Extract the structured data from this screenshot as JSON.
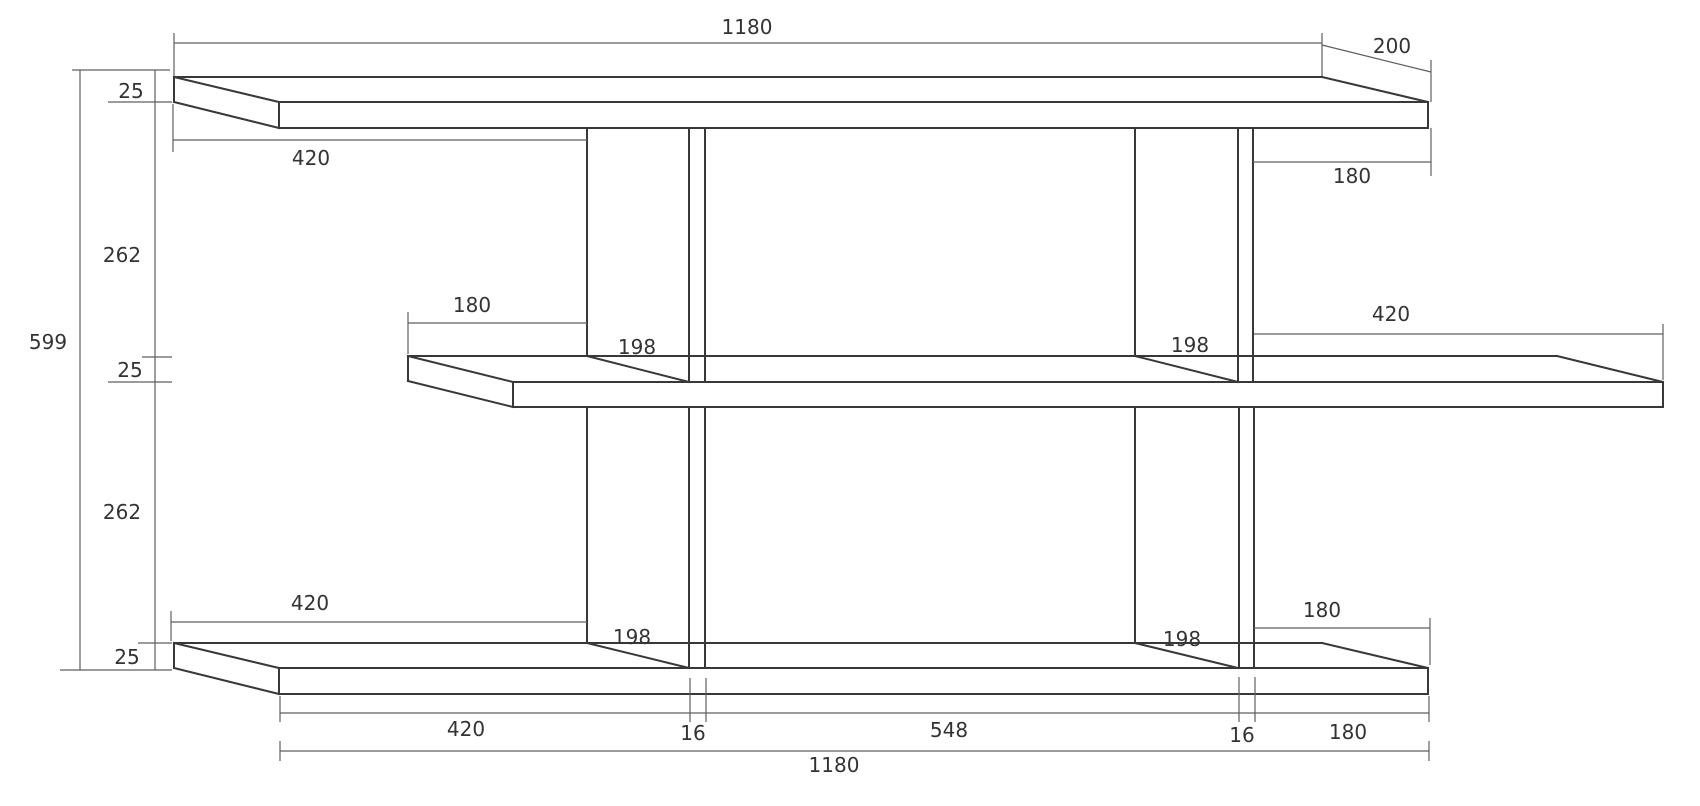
{
  "page": {
    "background": "#ffffff"
  },
  "summary": {
    "visible_dimension_values": [
      "1180",
      "200",
      "25",
      "420",
      "180",
      "262",
      "599",
      "198",
      "16",
      "548"
    ],
    "overall_width": "1180",
    "overall_height": "599",
    "shelf_depth": "200",
    "board_thickness": "25",
    "shelf_clear_gap": "262",
    "divider_thickness": "16",
    "divider_depth": "198",
    "bottom_segments": [
      "420",
      "16",
      "548",
      "16",
      "180"
    ]
  },
  "drawing": {
    "width": 1700,
    "height": 806,
    "background": "#ffffff",
    "object_color": "#383838",
    "dim_color": "#5f5f5f",
    "text_color": "#333333",
    "object_stroke_width": 2,
    "dim_stroke_width": 1.2,
    "font_size": 20,
    "parts": [
      {
        "name": "top-shelf",
        "role": "object",
        "strokes": [
          [
            [
              174,
              77
            ],
            [
              1322,
              77
            ]
          ],
          [
            [
              174,
              77
            ],
            [
              174,
              102
            ]
          ],
          [
            [
              174,
              77
            ],
            [
              279,
              102
            ]
          ],
          [
            [
              174,
              102
            ],
            [
              279,
              128
            ]
          ],
          [
            [
              279,
              102
            ],
            [
              279,
              128
            ]
          ],
          [
            [
              279,
              102
            ],
            [
              1428,
              102
            ]
          ],
          [
            [
              279,
              128
            ],
            [
              1428,
              128
            ]
          ],
          [
            [
              1322,
              77
            ],
            [
              1428,
              102
            ]
          ],
          [
            [
              1428,
              102
            ],
            [
              1428,
              128
            ]
          ]
        ]
      },
      {
        "name": "middle-shelf",
        "role": "object",
        "strokes": [
          [
            [
              408,
              356
            ],
            [
              1557,
              356
            ]
          ],
          [
            [
              408,
              356
            ],
            [
              408,
              381
            ]
          ],
          [
            [
              408,
              356
            ],
            [
              513,
              382
            ]
          ],
          [
            [
              408,
              381
            ],
            [
              513,
              407
            ]
          ],
          [
            [
              513,
              382
            ],
            [
              513,
              407
            ]
          ],
          [
            [
              513,
              382
            ],
            [
              1663,
              382
            ]
          ],
          [
            [
              513,
              407
            ],
            [
              1663,
              407
            ]
          ],
          [
            [
              1557,
              356
            ],
            [
              1663,
              382
            ]
          ],
          [
            [
              1663,
              382
            ],
            [
              1663,
              407
            ]
          ]
        ]
      },
      {
        "name": "bottom-shelf",
        "role": "object",
        "strokes": [
          [
            [
              174,
              643
            ],
            [
              1322,
              643
            ]
          ],
          [
            [
              174,
              643
            ],
            [
              174,
              668
            ]
          ],
          [
            [
              174,
              643
            ],
            [
              279,
              668
            ]
          ],
          [
            [
              174,
              668
            ],
            [
              279,
              694
            ]
          ],
          [
            [
              279,
              668
            ],
            [
              279,
              694
            ]
          ],
          [
            [
              279,
              668
            ],
            [
              1428,
              668
            ]
          ],
          [
            [
              279,
              694
            ],
            [
              1428,
              694
            ]
          ],
          [
            [
              1322,
              643
            ],
            [
              1428,
              668
            ]
          ],
          [
            [
              1428,
              668
            ],
            [
              1428,
              694
            ]
          ]
        ]
      },
      {
        "name": "divider-upper-left",
        "role": "object",
        "strokes": [
          [
            [
              587,
              128
            ],
            [
              587,
              356
            ]
          ],
          [
            [
              587,
              356
            ],
            [
              689,
              382
            ]
          ],
          [
            [
              689,
              128
            ],
            [
              689,
              382
            ]
          ],
          [
            [
              705,
              128
            ],
            [
              705,
              382
            ]
          ]
        ]
      },
      {
        "name": "divider-upper-right",
        "role": "object",
        "strokes": [
          [
            [
              1135,
              128
            ],
            [
              1135,
              356
            ]
          ],
          [
            [
              1135,
              356
            ],
            [
              1238,
              382
            ]
          ],
          [
            [
              1238,
              128
            ],
            [
              1238,
              382
            ]
          ],
          [
            [
              1253,
              128
            ],
            [
              1253,
              382
            ]
          ]
        ]
      },
      {
        "name": "divider-lower-left",
        "role": "object",
        "strokes": [
          [
            [
              587,
              407
            ],
            [
              587,
              643
            ]
          ],
          [
            [
              587,
              643
            ],
            [
              689,
              668
            ]
          ],
          [
            [
              689,
              407
            ],
            [
              689,
              668
            ]
          ],
          [
            [
              705,
              407
            ],
            [
              705,
              668
            ]
          ]
        ]
      },
      {
        "name": "divider-lower-right",
        "role": "object",
        "strokes": [
          [
            [
              1135,
              407
            ],
            [
              1135,
              643
            ]
          ],
          [
            [
              1135,
              643
            ],
            [
              1238,
              668
            ]
          ],
          [
            [
              1239,
              407
            ],
            [
              1239,
              668
            ]
          ],
          [
            [
              1254,
              407
            ],
            [
              1254,
              668
            ]
          ]
        ]
      },
      {
        "name": "dim-top-width-1180",
        "role": "dimension",
        "strokes": [
          [
            [
              174,
              43
            ],
            [
              1322,
              43
            ]
          ],
          [
            [
              174,
              33
            ],
            [
              174,
              76
            ]
          ],
          [
            [
              1322,
              33
            ],
            [
              1322,
              76
            ]
          ]
        ]
      },
      {
        "name": "dim-depth-200",
        "role": "dimension",
        "strokes": [
          [
            [
              1322,
              45
            ],
            [
              1431,
              72
            ]
          ],
          [
            [
              1431,
              60
            ],
            [
              1431,
              102
            ]
          ]
        ]
      },
      {
        "name": "dim-top-left-420",
        "role": "dimension",
        "strokes": [
          [
            [
              173,
              140
            ],
            [
              587,
              140
            ]
          ],
          [
            [
              173,
              104
            ],
            [
              173,
              152
            ]
          ]
        ]
      },
      {
        "name": "dim-top-right-180",
        "role": "dimension",
        "strokes": [
          [
            [
              1253,
              162
            ],
            [
              1431,
              162
            ]
          ],
          [
            [
              1431,
              128
            ],
            [
              1431,
              176
            ]
          ]
        ]
      },
      {
        "name": "dim-middle-left-180",
        "role": "dimension",
        "strokes": [
          [
            [
              408,
              323
            ],
            [
              587,
              323
            ]
          ],
          [
            [
              408,
              312
            ],
            [
              408,
              354
            ]
          ]
        ]
      },
      {
        "name": "dim-middle-right-420",
        "role": "dimension",
        "strokes": [
          [
            [
              1254,
              334
            ],
            [
              1663,
              334
            ]
          ],
          [
            [
              1663,
              324
            ],
            [
              1663,
              380
            ]
          ]
        ]
      },
      {
        "name": "dim-bottom-left-420",
        "role": "dimension",
        "strokes": [
          [
            [
              171,
              622
            ],
            [
              587,
              622
            ]
          ],
          [
            [
              171,
              611
            ],
            [
              171,
              641
            ]
          ]
        ]
      },
      {
        "name": "dim-bottom-right-180",
        "role": "dimension",
        "strokes": [
          [
            [
              1254,
              628
            ],
            [
              1430,
              628
            ]
          ],
          [
            [
              1430,
              618
            ],
            [
              1430,
              665
            ]
          ]
        ]
      },
      {
        "name": "dim-bottom-segments-row",
        "role": "dimension",
        "strokes": [
          [
            [
              280,
              713
            ],
            [
              1429,
              713
            ]
          ],
          [
            [
              280,
              696
            ],
            [
              280,
              722
            ]
          ],
          [
            [
              690,
              678
            ],
            [
              690,
              722
            ]
          ],
          [
            [
              706,
              678
            ],
            [
              706,
              722
            ]
          ],
          [
            [
              1239,
              677
            ],
            [
              1239,
              722
            ]
          ],
          [
            [
              1255,
              677
            ],
            [
              1255,
              722
            ]
          ],
          [
            [
              1429,
              696
            ],
            [
              1429,
              722
            ]
          ]
        ]
      },
      {
        "name": "dim-bottom-overall-1180",
        "role": "dimension",
        "strokes": [
          [
            [
              280,
              751
            ],
            [
              1429,
              751
            ]
          ],
          [
            [
              280,
              741
            ],
            [
              280,
              761
            ]
          ],
          [
            [
              1429,
              741
            ],
            [
              1429,
              761
            ]
          ]
        ]
      },
      {
        "name": "dim-left-height-column",
        "role": "dimension",
        "strokes": [
          [
            [
              80,
              70
            ],
            [
              80,
              670
            ]
          ],
          [
            [
              155,
              70
            ],
            [
              155,
              670
            ]
          ],
          [
            [
              72,
              70
            ],
            [
              170,
              70
            ]
          ],
          [
            [
              108,
              102
            ],
            [
              172,
              102
            ]
          ],
          [
            [
              142,
              357
            ],
            [
              172,
              357
            ]
          ],
          [
            [
              108,
              382
            ],
            [
              172,
              382
            ]
          ],
          [
            [
              138,
              643
            ],
            [
              172,
              643
            ]
          ],
          [
            [
              60,
              670
            ],
            [
              172,
              670
            ]
          ]
        ]
      }
    ],
    "labels": [
      {
        "name": "dim-label-top-width",
        "text": "1180",
        "x": 747,
        "y": 27
      },
      {
        "name": "dim-label-depth",
        "text": "200",
        "x": 1392,
        "y": 46
      },
      {
        "name": "dim-label-thickness-top",
        "text": "25",
        "x": 131,
        "y": 91
      },
      {
        "name": "dim-label-top-left-420",
        "text": "420",
        "x": 311,
        "y": 158
      },
      {
        "name": "dim-label-top-right-180",
        "text": "180",
        "x": 1352,
        "y": 176
      },
      {
        "name": "dim-label-gap-upper-262",
        "text": "262",
        "x": 122,
        "y": 255
      },
      {
        "name": "dim-label-middle-left-180",
        "text": "180",
        "x": 472,
        "y": 305
      },
      {
        "name": "dim-label-middle-right-420",
        "text": "420",
        "x": 1391,
        "y": 314
      },
      {
        "name": "dim-label-overall-height",
        "text": "599",
        "x": 48,
        "y": 342
      },
      {
        "name": "dim-label-divider-ul-198",
        "text": "198",
        "x": 637,
        "y": 347
      },
      {
        "name": "dim-label-divider-ur-198",
        "text": "198",
        "x": 1190,
        "y": 345
      },
      {
        "name": "dim-label-thickness-middle",
        "text": "25",
        "x": 130,
        "y": 370
      },
      {
        "name": "dim-label-gap-lower-262",
        "text": "262",
        "x": 122,
        "y": 512
      },
      {
        "name": "dim-label-bottom-left-420",
        "text": "420",
        "x": 310,
        "y": 603
      },
      {
        "name": "dim-label-bottom-right-180",
        "text": "180",
        "x": 1322,
        "y": 610
      },
      {
        "name": "dim-label-divider-ll-198",
        "text": "198",
        "x": 632,
        "y": 637
      },
      {
        "name": "dim-label-divider-lr-198",
        "text": "198",
        "x": 1182,
        "y": 639
      },
      {
        "name": "dim-label-thickness-bottom",
        "text": "25",
        "x": 127,
        "y": 657
      },
      {
        "name": "dim-label-seg-420",
        "text": "420",
        "x": 466,
        "y": 729
      },
      {
        "name": "dim-label-seg-16-left",
        "text": "16",
        "x": 693,
        "y": 733
      },
      {
        "name": "dim-label-seg-548",
        "text": "548",
        "x": 949,
        "y": 730
      },
      {
        "name": "dim-label-seg-16-right",
        "text": "16",
        "x": 1242,
        "y": 735
      },
      {
        "name": "dim-label-seg-180",
        "text": "180",
        "x": 1348,
        "y": 732
      },
      {
        "name": "dim-label-bottom-overall",
        "text": "1180",
        "x": 834,
        "y": 765
      }
    ]
  }
}
